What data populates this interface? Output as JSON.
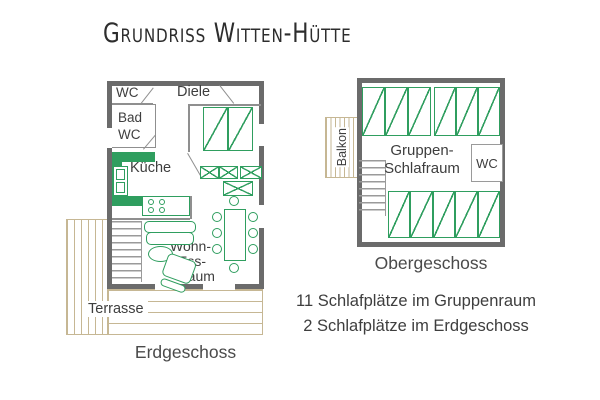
{
  "title": "Grundriss Witten-Hütte",
  "colors": {
    "green": "#2f9e5f",
    "wood": "#c6b794",
    "wall": "#6b6b6b",
    "text": "#3e3e3e"
  },
  "ground_floor": {
    "caption": "Erdgeschoss",
    "rooms": {
      "wc": "WC",
      "bad_line1": "Bad",
      "bad_line2": "WC",
      "diele": "Diele",
      "kueche": "Küche",
      "wohn_line1": "Wohn-",
      "wohn_line2": "Ess-",
      "wohn_line3": "raum",
      "terrasse": "Terrasse"
    },
    "bed_count": 2
  },
  "upper_floor": {
    "caption": "Obergeschoss",
    "rooms": {
      "balkon": "Balkon",
      "schlafraum_line1": "Gruppen-",
      "schlafraum_line2": "Schlafraum",
      "wc": "WC"
    },
    "bed_count_top": 6,
    "bed_count_bottom": 5
  },
  "notes": {
    "line1": "11 Schlafplätze im Gruppenraum",
    "line2": "2 Schlafplätze im Erdgeschoss"
  }
}
